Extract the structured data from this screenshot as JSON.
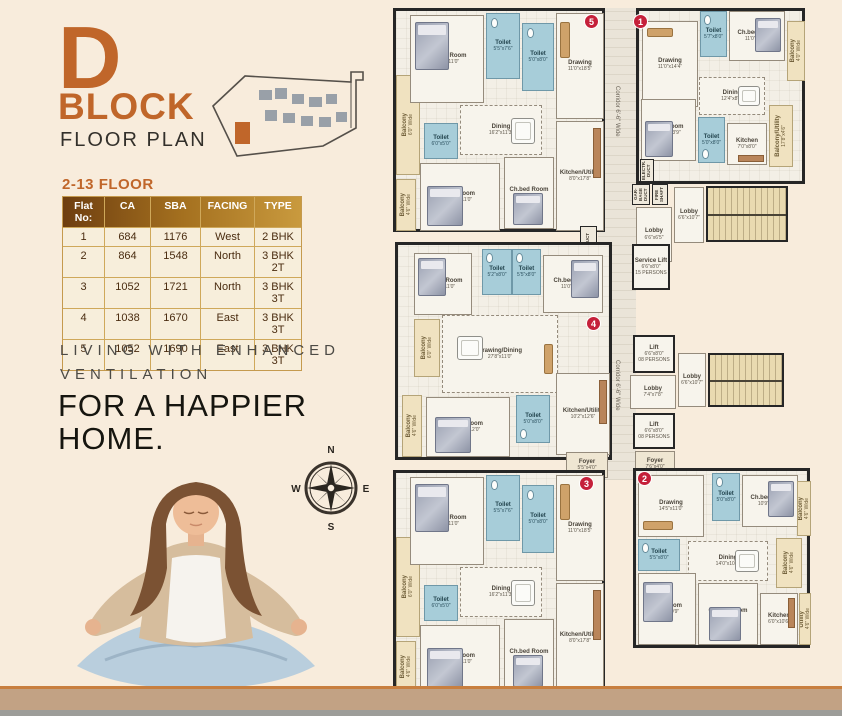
{
  "colors": {
    "accent_orange": "#c0662a",
    "badge_red": "#c5203a",
    "toilet_blue": "#a7cdd9",
    "balcony_tan": "#f0e2c0",
    "wall_dark": "#262626",
    "footer_tan": "#c2a284"
  },
  "title": {
    "letter": "D",
    "block": "BLOCK",
    "subtitle": "FLOOR PLAN"
  },
  "floor_heading": "2-13 FLOOR",
  "table": {
    "headers": [
      "Flat No:",
      "CA",
      "SBA",
      "FACING",
      "TYPE"
    ],
    "rows": [
      [
        "1",
        "684",
        "1176",
        "West",
        "2 BHK"
      ],
      [
        "2",
        "864",
        "1548",
        "North",
        "3 BHK 2T"
      ],
      [
        "3",
        "1052",
        "1721",
        "North",
        "3 BHK 3T"
      ],
      [
        "4",
        "1038",
        "1670",
        "East",
        "3 BHK 3T"
      ],
      [
        "5",
        "1052",
        "1690",
        "East",
        "3 BHK 3T"
      ]
    ]
  },
  "tagline": {
    "small1": "LIVING WITH ENHANCED",
    "small2": "VENTILATION",
    "big1": "FOR A HAPPIER",
    "big2": "HOME."
  },
  "compass": {
    "north": "N",
    "east": "E",
    "south": "S",
    "west": "W"
  },
  "plan": {
    "corridor_label": "Corridor 6'-6\" Wide",
    "badges": {
      "b1": "1",
      "b2": "2",
      "b3": "3",
      "b4": "4",
      "b5": "5"
    },
    "unit5": {
      "chbed1": {
        "name": "Ch.bed Room",
        "dim": "10'6\"x11'0\""
      },
      "toilet1": {
        "name": "Toilet",
        "dim": "5'5\"x7'6\""
      },
      "toilet2": {
        "name": "Toilet",
        "dim": "5'0\"x8'0\""
      },
      "drawing": {
        "name": "Drawing",
        "dim": "11'0\"x18'5\""
      },
      "dining": {
        "name": "Dining",
        "dim": "16'2\"x11'3\""
      },
      "balcony1": {
        "name": "Balcony",
        "dim": "6'0\" Wide"
      },
      "toilet3": {
        "name": "Toilet",
        "dim": "6'0\"x5'0\""
      },
      "bedroom": {
        "name": "Bed Room",
        "dim": "14'0\"x11'0\""
      },
      "chbed2": {
        "name": "Ch.bed Room",
        "dim": "10'9\"x12'0\""
      },
      "kitchen": {
        "name": "Kitchen/Utility",
        "dim": "8'0\"x17'8\""
      },
      "balcony2": {
        "name": "Balcony",
        "dim": "4'6\" Wide"
      }
    },
    "unit1": {
      "drawing": {
        "name": "Drawing",
        "dim": "11'0\"x14'4\""
      },
      "toilet1": {
        "name": "Toilet",
        "dim": "5'7\"x8'0\""
      },
      "chbed1": {
        "name": "Ch.bed Room",
        "dim": "11'0\"x10'6\""
      },
      "balcony1": {
        "name": "Balcony",
        "dim": "4'0\" Wide"
      },
      "bedroom": {
        "name": "Bed Room",
        "dim": "11'2\"x13'9\""
      },
      "dining": {
        "name": "Dining",
        "dim": "12'4\"x8'0\""
      },
      "toilet2": {
        "name": "Toilet",
        "dim": "5'0\"x8'0\""
      },
      "kitchen": {
        "name": "Kitchen",
        "dim": "7'0\"x8'0\""
      },
      "balc_util": {
        "name": "Balcony/Utility",
        "dim": "17'8\"x4'6\""
      },
      "electr": "ELECTR. DUCT"
    },
    "unit4": {
      "chbed1": {
        "name": "Ch.bed Room",
        "dim": "12'0\"x11'0\""
      },
      "toilet1": {
        "name": "Toilet",
        "dim": "5'2\"x8'0\""
      },
      "toilet2": {
        "name": "Toilet",
        "dim": "5'5\"x8'0\""
      },
      "chbed2": {
        "name": "Ch.bed Room",
        "dim": "11'0\"x11'0\""
      },
      "balcony1": {
        "name": "Balcony",
        "dim": "6'0\" Wide"
      },
      "drawdine": {
        "name": "Drawing/Dining",
        "dim": "27'8\"x11'0\""
      },
      "bedroom": {
        "name": "Bed Room",
        "dim": "14'0\"x12'0\""
      },
      "toilet3": {
        "name": "Toilet",
        "dim": "5'0\"x8'0\""
      },
      "kitchen": {
        "name": "Kitchen/Utility",
        "dim": "10'2\"x12'6\""
      },
      "balcony2": {
        "name": "Balcony",
        "dim": "4'6\" Wide"
      }
    },
    "unit3": {
      "chbed1": {
        "name": "Ch.bed Room",
        "dim": "10'6\"x11'0\""
      },
      "toilet1": {
        "name": "Toilet",
        "dim": "5'5\"x7'6\""
      },
      "toilet2": {
        "name": "Toilet",
        "dim": "5'0\"x8'0\""
      },
      "drawing": {
        "name": "Drawing",
        "dim": "11'0\"x18'5\""
      },
      "dining": {
        "name": "Dining",
        "dim": "16'2\"x11'3\""
      },
      "balcony1": {
        "name": "Balcony",
        "dim": "6'0\" Wide"
      },
      "toilet3": {
        "name": "Toilet",
        "dim": "6'0\"x5'0\""
      },
      "bedroom": {
        "name": "Bed Room",
        "dim": "14'0\"x11'0\""
      },
      "chbed2": {
        "name": "Ch.bed Room",
        "dim": "10'9\"x12'0\""
      },
      "kitchen": {
        "name": "Kitchen/Utility",
        "dim": "8'0\"x17'8\""
      },
      "balcony2": {
        "name": "Balcony",
        "dim": "4'6\" Wide"
      },
      "foyer": {
        "name": "Foyer",
        "dim": "5'5\"x4'0\""
      }
    },
    "unit2": {
      "drawing": {
        "name": "Drawing",
        "dim": "14'5\"x11'0\""
      },
      "toilet1": {
        "name": "Toilet",
        "dim": "5'0\"x8'0\""
      },
      "chbed1": {
        "name": "Ch.bed Room",
        "dim": "10'9\"x11'0\""
      },
      "balcony1": {
        "name": "Balcony",
        "dim": "4'6\" Wide"
      },
      "toilet2": {
        "name": "Toilet",
        "dim": "5'5\"x8'0\""
      },
      "dining": {
        "name": "Dining",
        "dim": "14'0\"x10'0\""
      },
      "balcony2": {
        "name": "Balcony",
        "dim": "4'6\" Wide"
      },
      "bedroom": {
        "name": "Bed Room",
        "dim": "11'6\"x10'9\""
      },
      "chbed2": {
        "name": "Ch.bed Room",
        "dim": "10'0\"x13'2\""
      },
      "kitchen": {
        "name": "Kitchen",
        "dim": "6'0\"x10'6\""
      },
      "utility": {
        "name": "Utility",
        "dim": "4'6\" Wide"
      }
    },
    "core": {
      "garbage": "GAR-BAGE DUCT",
      "fire": "FIRE SHAFT",
      "drain": "DRAIN DUCT",
      "lobby1": {
        "name": "Lobby",
        "dim": "6'6\"x10'7\""
      },
      "lobby2": {
        "name": "Lobby",
        "dim": "6'6\"x6'5\""
      },
      "service_lift": {
        "name": "Service Lift",
        "dim": "6'6\"x8'0\"",
        "persons": "15 PERSONS"
      },
      "lift1": {
        "name": "Lift",
        "dim": "6'6\"x8'0\"",
        "persons": "08 PERSONS"
      },
      "lobby3": {
        "name": "Lobby",
        "dim": "7'4\"x7'8\""
      },
      "lobby4": {
        "name": "Lobby",
        "dim": "6'6\"x10'7\""
      },
      "lift2": {
        "name": "Lift",
        "dim": "6'6\"x8'0\"",
        "persons": "08 PERSONS"
      },
      "foyer2": {
        "name": "Foyer",
        "dim": "7'6\"x4'0\""
      }
    }
  }
}
